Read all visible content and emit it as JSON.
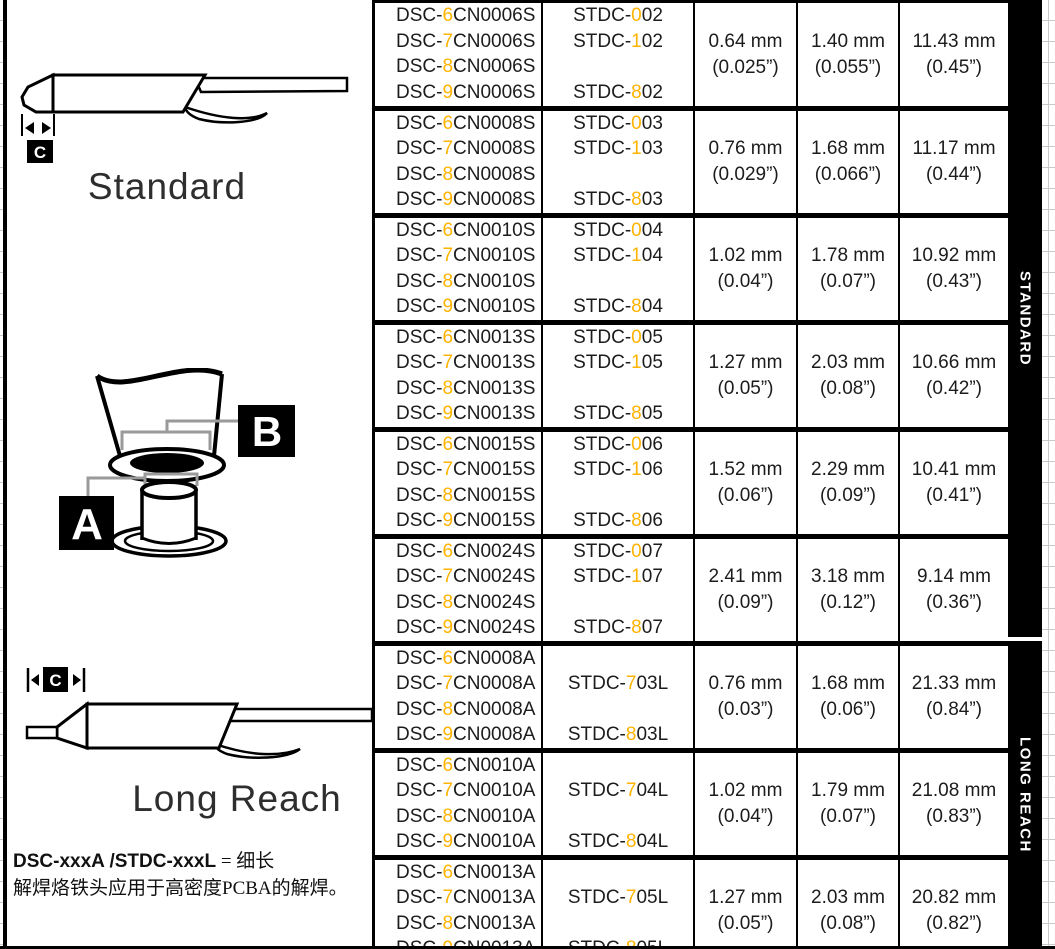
{
  "colors": {
    "accent": "#FFB300",
    "ink": "#000000",
    "bar_bg": "#000000",
    "bar_text": "#FFFFFF"
  },
  "figures": {
    "standard": {
      "label": "Standard",
      "marker": "C"
    },
    "cross_section": {
      "marker_outer": "B",
      "marker_inner": "A"
    },
    "long_reach": {
      "label": "Long Reach",
      "marker": "C"
    },
    "note": {
      "codes": "DSC-xxxA /STDC-xxxL",
      "equals": " = 细长",
      "text": "解焊烙铁头应用于高密度PCBA的解焊。"
    }
  },
  "sidebar": {
    "standard_label": "STANDARD",
    "long_reach_label": "LONG REACH"
  },
  "table": {
    "rows": [
      {
        "section": "standard",
        "dsc": [
          "DSC-6CN0006S",
          "DSC-7CN0006S",
          "DSC-8CN0006S",
          "DSC-9CN0006S"
        ],
        "stdc": [
          "STDC-002",
          "STDC-102",
          "",
          "STDC-802"
        ],
        "dims": [
          [
            "0.64 mm",
            "(0.025”)"
          ],
          [
            "1.40 mm",
            "(0.055”)"
          ],
          [
            "11.43 mm",
            "(0.45”)"
          ]
        ]
      },
      {
        "section": "standard",
        "dsc": [
          "DSC-6CN0008S",
          "DSC-7CN0008S",
          "DSC-8CN0008S",
          "DSC-9CN0008S"
        ],
        "stdc": [
          "STDC-003",
          "STDC-103",
          "",
          "STDC-803"
        ],
        "dims": [
          [
            "0.76 mm",
            "(0.029”)"
          ],
          [
            "1.68 mm",
            "(0.066”)"
          ],
          [
            "11.17 mm",
            "(0.44”)"
          ]
        ]
      },
      {
        "section": "standard",
        "dsc": [
          "DSC-6CN0010S",
          "DSC-7CN0010S",
          "DSC-8CN0010S",
          "DSC-9CN0010S"
        ],
        "stdc": [
          "STDC-004",
          "STDC-104",
          "",
          "STDC-804"
        ],
        "dims": [
          [
            "1.02 mm",
            "(0.04”)"
          ],
          [
            "1.78 mm",
            "(0.07”)"
          ],
          [
            "10.92 mm",
            "(0.43”)"
          ]
        ]
      },
      {
        "section": "standard",
        "dsc": [
          "DSC-6CN0013S",
          "DSC-7CN0013S",
          "DSC-8CN0013S",
          "DSC-9CN0013S"
        ],
        "stdc": [
          "STDC-005",
          "STDC-105",
          "",
          "STDC-805"
        ],
        "dims": [
          [
            "1.27 mm",
            "(0.05”)"
          ],
          [
            "2.03 mm",
            "(0.08”)"
          ],
          [
            "10.66 mm",
            "(0.42”)"
          ]
        ]
      },
      {
        "section": "standard",
        "dsc": [
          "DSC-6CN0015S",
          "DSC-7CN0015S",
          "DSC-8CN0015S",
          "DSC-9CN0015S"
        ],
        "stdc": [
          "STDC-006",
          "STDC-106",
          "",
          "STDC-806"
        ],
        "dims": [
          [
            "1.52 mm",
            "(0.06”)"
          ],
          [
            "2.29 mm",
            "(0.09”)"
          ],
          [
            "10.41 mm",
            "(0.41”)"
          ]
        ]
      },
      {
        "section": "standard",
        "dsc": [
          "DSC-6CN0024S",
          "DSC-7CN0024S",
          "DSC-8CN0024S",
          "DSC-9CN0024S"
        ],
        "stdc": [
          "STDC-007",
          "STDC-107",
          "",
          "STDC-807"
        ],
        "dims": [
          [
            "2.41 mm",
            "(0.09”)"
          ],
          [
            "3.18 mm",
            "(0.12”)"
          ],
          [
            "9.14 mm",
            "(0.36”)"
          ]
        ]
      },
      {
        "section": "long",
        "dsc": [
          "DSC-6CN0008A",
          "DSC-7CN0008A",
          "DSC-8CN0008A",
          "DSC-9CN0008A"
        ],
        "stdc": [
          "",
          "STDC-703L",
          "",
          "STDC-803L"
        ],
        "dims": [
          [
            "0.76 mm",
            "(0.03”)"
          ],
          [
            "1.68 mm",
            "(0.06”)"
          ],
          [
            "21.33 mm",
            "(0.84”)"
          ]
        ]
      },
      {
        "section": "long",
        "dsc": [
          "DSC-6CN0010A",
          "DSC-7CN0010A",
          "DSC-8CN0010A",
          "DSC-9CN0010A"
        ],
        "stdc": [
          "",
          "STDC-704L",
          "",
          "STDC-804L"
        ],
        "dims": [
          [
            "1.02 mm",
            "(0.04”)"
          ],
          [
            "1.79 mm",
            "(0.07”)"
          ],
          [
            "21.08 mm",
            "(0.83”)"
          ]
        ]
      },
      {
        "section": "long",
        "dsc": [
          "DSC-6CN0013A",
          "DSC-7CN0013A",
          "DSC-8CN0013A",
          "DSC-9CN0013A"
        ],
        "stdc": [
          "",
          "STDC-705L",
          "",
          "STDC-805L"
        ],
        "dims": [
          [
            "1.27 mm",
            "(0.05”)"
          ],
          [
            "2.03 mm",
            "(0.08”)"
          ],
          [
            "20.82 mm",
            "(0.82”)"
          ]
        ]
      }
    ]
  }
}
